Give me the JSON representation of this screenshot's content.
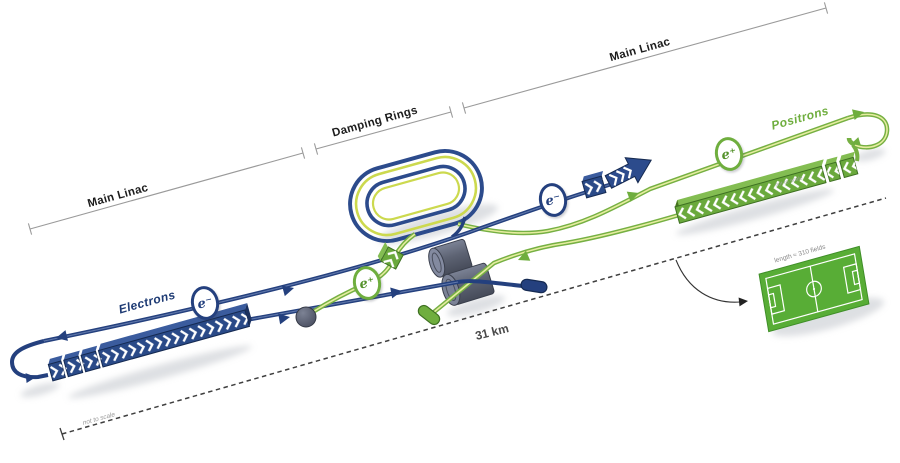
{
  "diagram": {
    "type": "linear-collider-schematic",
    "bracket": {
      "main_linac_left": "Main Linac",
      "damping_rings": "Damping Rings",
      "main_linac_right": "Main Linac"
    },
    "beams": {
      "electrons_label": "Electrons",
      "positrons_label": "Positrons",
      "electron_badge": "e⁻",
      "positron_badge": "e⁺"
    },
    "scale": {
      "total_length": "31 km",
      "not_to_scale_note": "not to scale",
      "positron_linac_note": "not to scale",
      "football_field_caption": "length ≈ 310 fields"
    },
    "colors": {
      "electron_blue": "#24407e",
      "positron_green": "#6fae3e",
      "damping_ring_yellow": "#ccd94e",
      "detector_gray": "#5a6070",
      "field_green": "#58ad36",
      "dimension_gray": "#999999"
    }
  }
}
